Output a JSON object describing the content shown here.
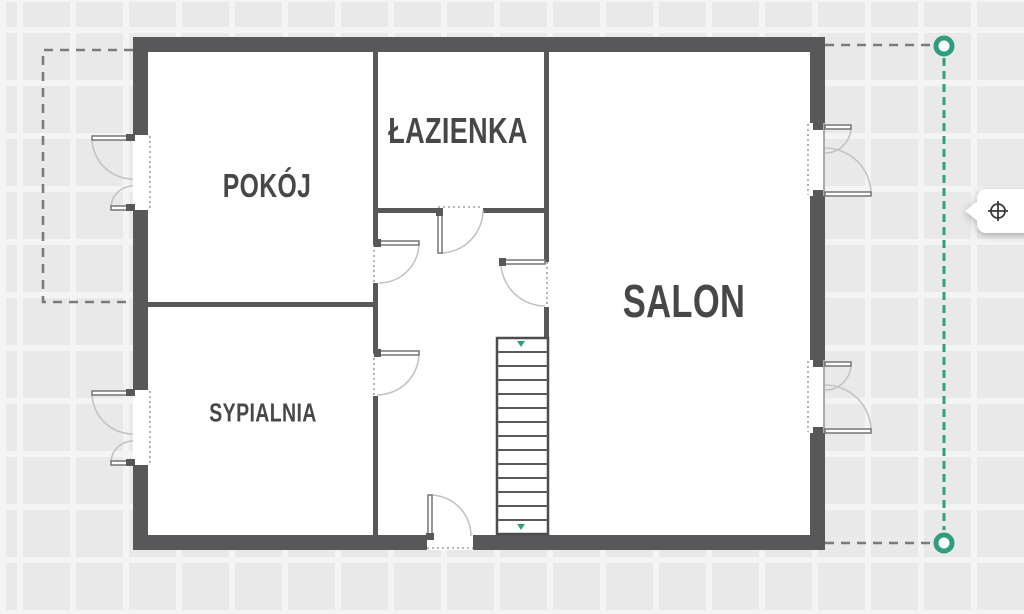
{
  "rooms": [
    {
      "id": "pokoj",
      "label": "POKÓJ"
    },
    {
      "id": "lazienka",
      "label": "ŁAZIENKA"
    },
    {
      "id": "salon",
      "label": "SALON"
    },
    {
      "id": "sypialnia",
      "label": "SYPIALNIA"
    }
  ],
  "stairs": {
    "treads": 14
  },
  "measure_guide": {
    "handle_count": 2,
    "orientation": "vertical"
  },
  "icons": {
    "tooltip": "crosshair-target-icon"
  },
  "colors": {
    "accent": "#2f9e80",
    "wall": "#58585a",
    "label": "#474747",
    "dash_gray": "#7b7b7b",
    "canvas_bg": "#e9e9ea",
    "grid_line": "#f4f4f5"
  }
}
